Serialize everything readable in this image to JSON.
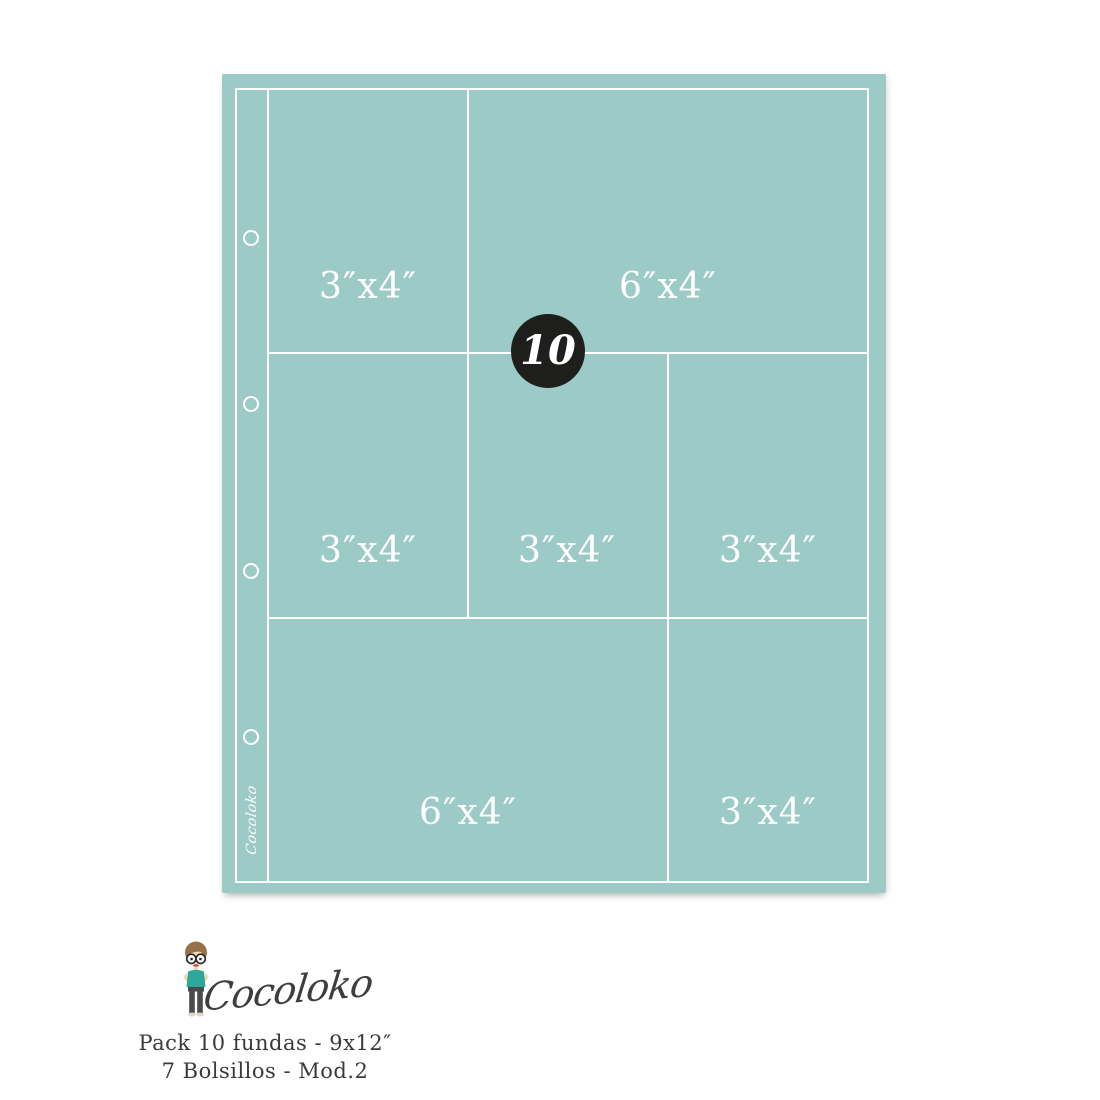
{
  "page": {
    "badge_count": "10",
    "signature": "Cocoloko",
    "pockets": [
      {
        "row": 1,
        "label": "3″x4″"
      },
      {
        "row": 1,
        "label": "6″x4″"
      },
      {
        "row": 2,
        "label": "3″x4″"
      },
      {
        "row": 2,
        "label": "3″x4″"
      },
      {
        "row": 2,
        "label": "3″x4″"
      },
      {
        "row": 3,
        "label": "6″x4″"
      },
      {
        "row": 3,
        "label": "3″x4″"
      }
    ]
  },
  "branding": {
    "logo": "Cocoloko",
    "pack_line": "Pack 10 fundas - 9x12″",
    "model_line": "7 Bolsillos - Mod.2"
  },
  "colors": {
    "page_teal": "#9CCAC6",
    "grid_white": "#FFFFFF",
    "badge_black": "#1E1E1C",
    "text_dark": "#3A3A38",
    "mascot_shirt_teal": "#2BA89A"
  }
}
